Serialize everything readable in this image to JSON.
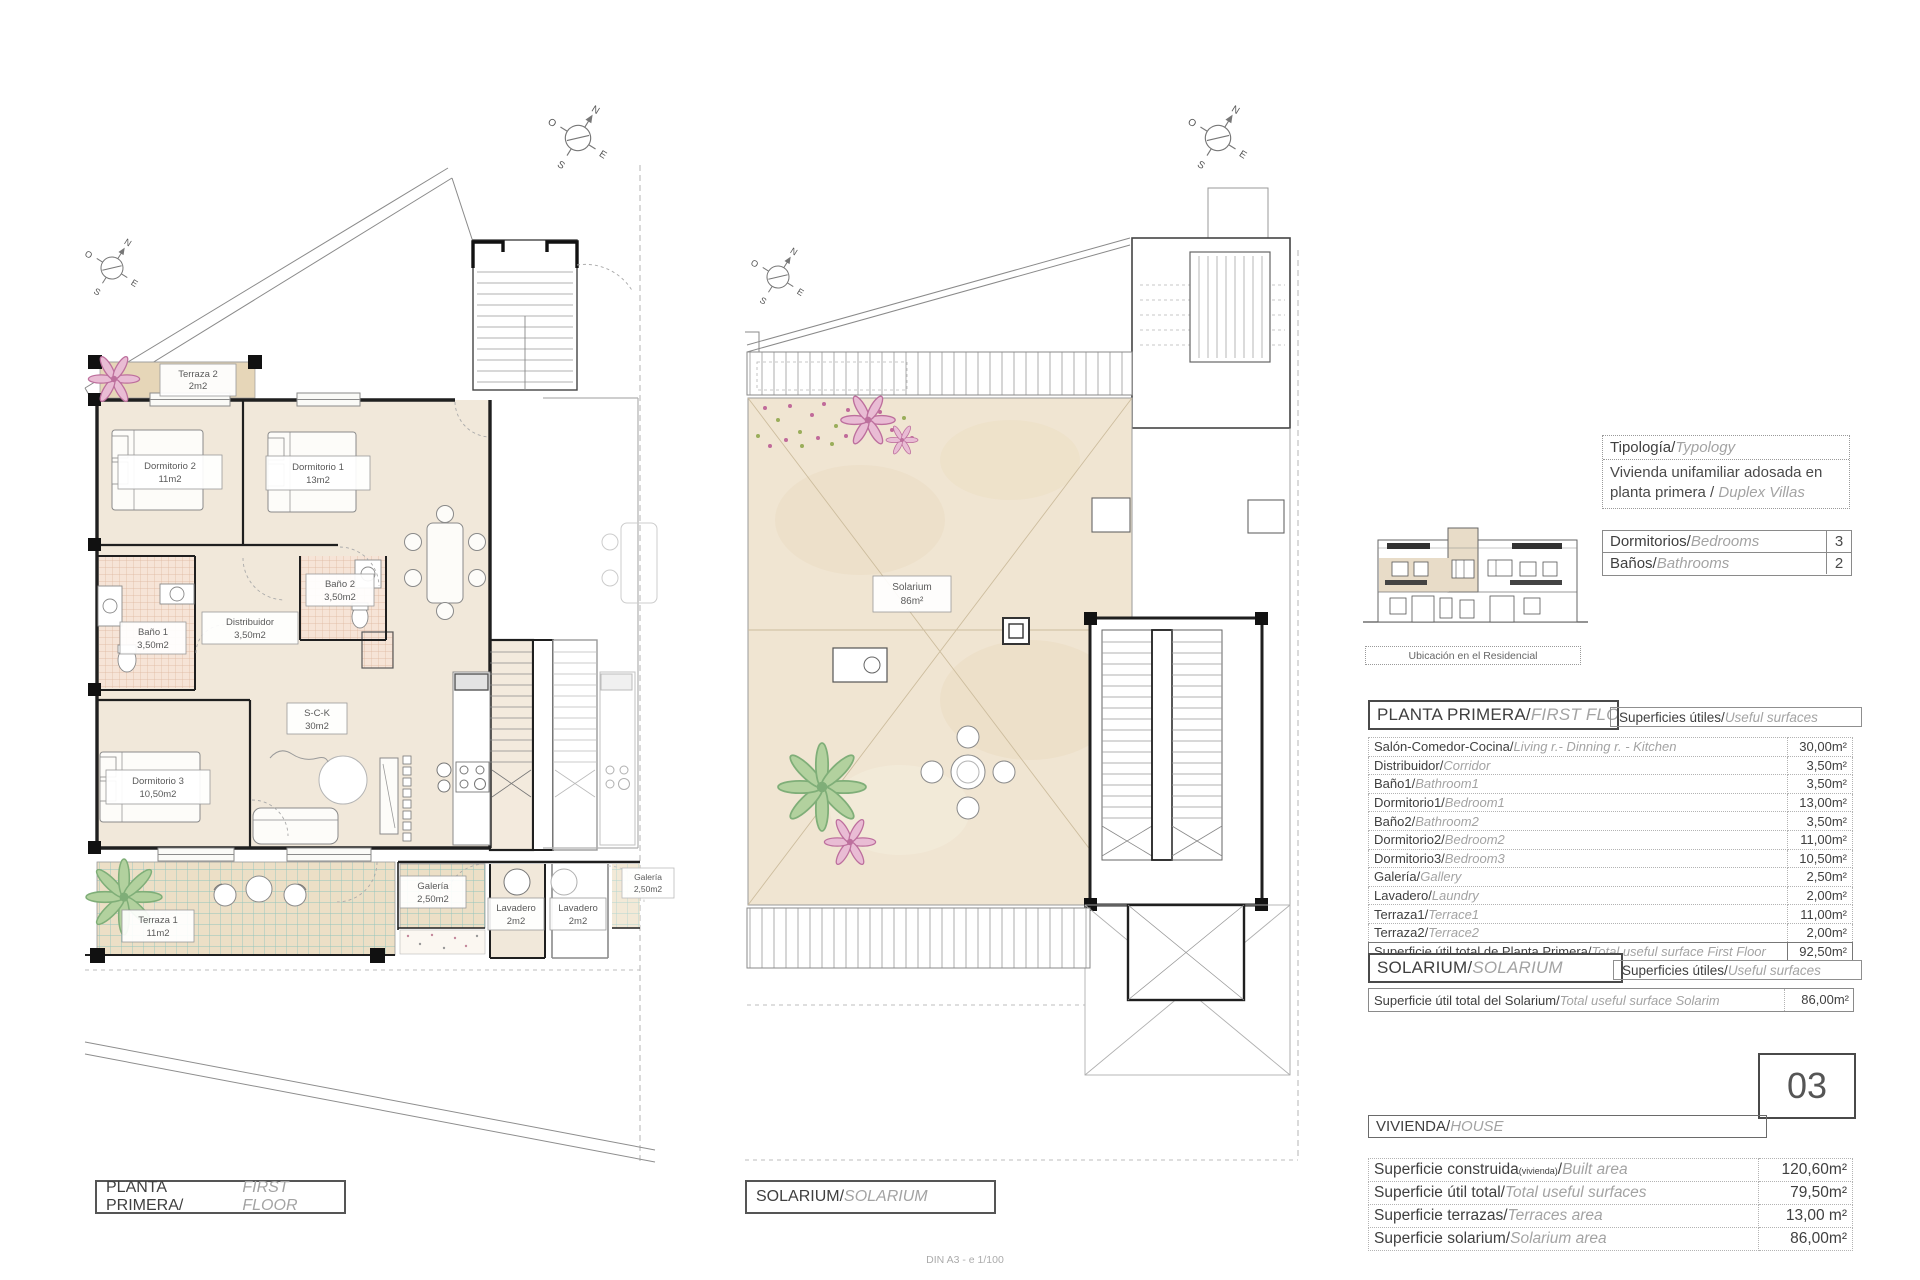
{
  "compass": {
    "north": "N",
    "south": "S",
    "east": "E",
    "west": "O"
  },
  "footer": {
    "scale_note": "DIN A3 - e 1/100"
  },
  "plan_first_floor": {
    "title_main": "PLANTA PRIMERA/",
    "title_italic": "FIRST FLOOR",
    "rooms": {
      "terraza2": {
        "name": "Terraza 2",
        "area": "2m2"
      },
      "dormitorio2": {
        "name": "Dormitorio 2",
        "area": "11m2"
      },
      "dormitorio1": {
        "name": "Dormitorio 1",
        "area": "13m2"
      },
      "bano1": {
        "name": "Baño 1",
        "area": "3,50m2"
      },
      "bano2": {
        "name": "Baño 2",
        "area": "3,50m2"
      },
      "distribuidor": {
        "name": "Distribuidor",
        "area": "3,50m2"
      },
      "sck": {
        "name": "S-C-K",
        "area": "30m2"
      },
      "dormitorio3": {
        "name": "Dormitorio 3",
        "area": "10,50m2"
      },
      "galeria": {
        "name": "Galería",
        "area": "2,50m2"
      },
      "lavadero1": {
        "name": "Lavadero",
        "area": "2m2"
      },
      "lavadero2": {
        "name": "Lavadero",
        "area": "2m2"
      },
      "terraza1": {
        "name": "Terraza 1",
        "area": "11m2"
      },
      "galeria_neighbor": {
        "name": "Galería",
        "area": "2,50m2"
      }
    }
  },
  "plan_solarium": {
    "title_main": "SOLARIUM/",
    "title_italic": "SOLARIUM",
    "room": {
      "name": "Solarium",
      "area": "86m²"
    }
  },
  "panel": {
    "typology": {
      "label_main": "Tipología/",
      "label_italic": "Typology",
      "value_line1": "Vivienda unifamiliar adosada en",
      "value_line2_main": "planta primera / ",
      "value_line2_italic": "Duplex Villas"
    },
    "location_caption": "Ubicación en el Residencial",
    "counts": [
      {
        "label_main": "Dormitorios/",
        "label_italic": "Bedrooms",
        "value": "3"
      },
      {
        "label_main": "Baños/",
        "label_italic": "Bathrooms",
        "value": "2"
      }
    ],
    "first_floor": {
      "header_main": "PLANTA PRIMERA/",
      "header_italic": "FIRST FLOOR",
      "surfaces_main": "Superficies útiles/",
      "surfaces_italic": "Useful surfaces",
      "rows": [
        {
          "label_main": "Salón-Comedor-Cocina/",
          "label_italic": "Living r.- Dinning r. - Kitchen",
          "value": "30,00m²"
        },
        {
          "label_main": "Distribuidor/",
          "label_italic": "Corridor",
          "value": "3,50m²"
        },
        {
          "label_main": "Baño1/",
          "label_italic": "Bathroom1",
          "value": "3,50m²"
        },
        {
          "label_main": "Dormitorio1/",
          "label_italic": "Bedroom1",
          "value": "13,00m²"
        },
        {
          "label_main": "Baño2/",
          "label_italic": "Bathroom2",
          "value": "3,50m²"
        },
        {
          "label_main": "Dormitorio2/",
          "label_italic": "Bedroom2",
          "value": "11,00m²"
        },
        {
          "label_main": "Dormitorio3/",
          "label_italic": "Bedroom3",
          "value": "10,50m²"
        },
        {
          "label_main": "Galería/",
          "label_italic": "Gallery",
          "value": "2,50m²"
        },
        {
          "label_main": "Lavadero/",
          "label_italic": "Laundry",
          "value": "2,00m²"
        },
        {
          "label_main": "Terraza1/",
          "label_italic": "Terrace1",
          "value": "11,00m²"
        },
        {
          "label_main": "Terraza2/",
          "label_italic": "Terrace2",
          "value": "2,00m²"
        }
      ],
      "total_row": {
        "label_main": "Superficie útil total de Planta Primera/",
        "label_italic": "Total useful surface First Floor",
        "value": "92,50m²"
      }
    },
    "solarium": {
      "header_main": "SOLARIUM/",
      "header_italic": "SOLARIUM",
      "surfaces_main": "Superficies útiles/",
      "surfaces_italic": "Useful surfaces",
      "total_row": {
        "label_main": "Superficie útil total del Solarium/",
        "label_italic": "Total useful surface Solarim",
        "value": "86,00m²"
      }
    },
    "unit_number": "03",
    "vivienda": {
      "header_main": "VIVIENDA/",
      "header_italic": "HOUSE",
      "row1": {
        "label_main": "Superficie construida",
        "label_sub": "(vivienda)",
        "label_slash": "/",
        "label_italic": "Built area",
        "value": "120,60m²"
      },
      "rows": [
        {
          "label_main": "Superficie útil total/",
          "label_italic": "Total useful surfaces",
          "value": "79,50m²"
        },
        {
          "label_main": "Superficie terrazas/",
          "label_italic": "Terraces area",
          "value": "13,00 m²"
        },
        {
          "label_main": "Superficie solarium/",
          "label_italic": "Solarium area",
          "value": "86,00m²"
        }
      ]
    }
  }
}
